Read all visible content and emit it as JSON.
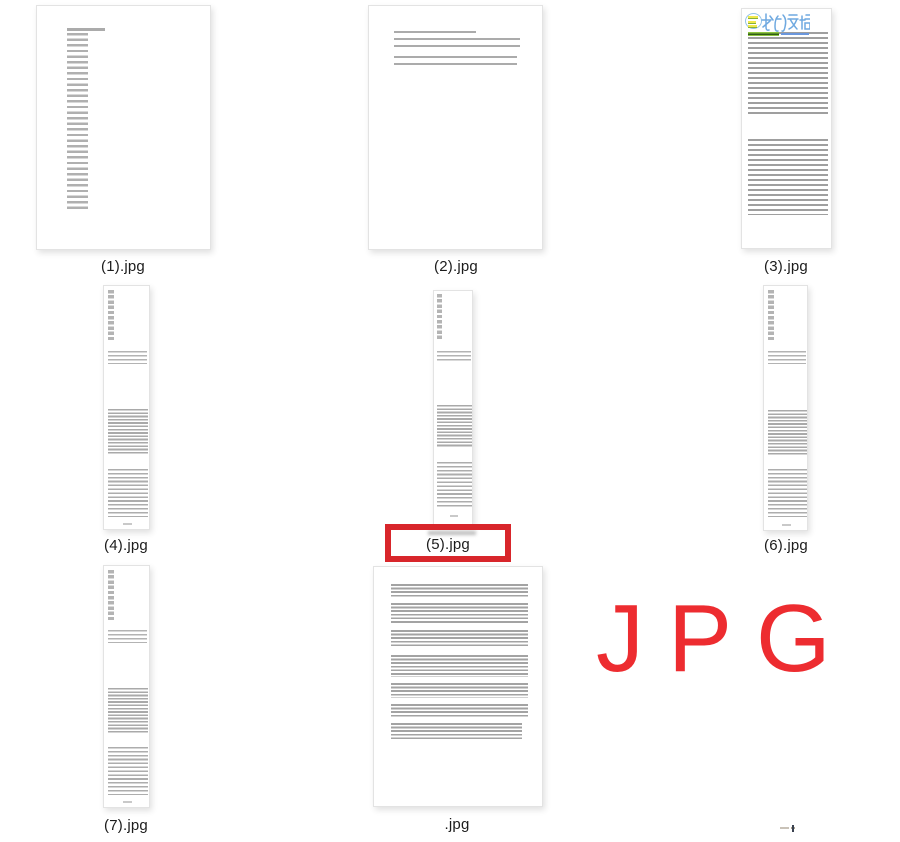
{
  "window": {
    "background_color": "#ffffff",
    "description": "grid of jpg page thumbnails"
  },
  "thumbnails": {
    "item1": {
      "label": "(1).jpg"
    },
    "item2": {
      "label": "(2).jpg"
    },
    "item3": {
      "label": "(3).jpg",
      "handwriting_text": "我的文档",
      "handwriting_color": "#6fa9e0",
      "stamp_highlight_color": "#f0e94c",
      "inline_highlight_color": "#8cc43e"
    },
    "item4": {
      "label": "(4).jpg"
    },
    "item5": {
      "label": "(5).jpg",
      "selected": true
    },
    "item6": {
      "label": "(6).jpg"
    },
    "item7": {
      "label": "(7).jpg"
    },
    "item8": {
      "label": ".jpg"
    }
  },
  "selection_box": {
    "color": "#d8262b",
    "target_label": "(5).jpg"
  },
  "watermark": {
    "text": "JPG",
    "color": "#ed2c30"
  }
}
